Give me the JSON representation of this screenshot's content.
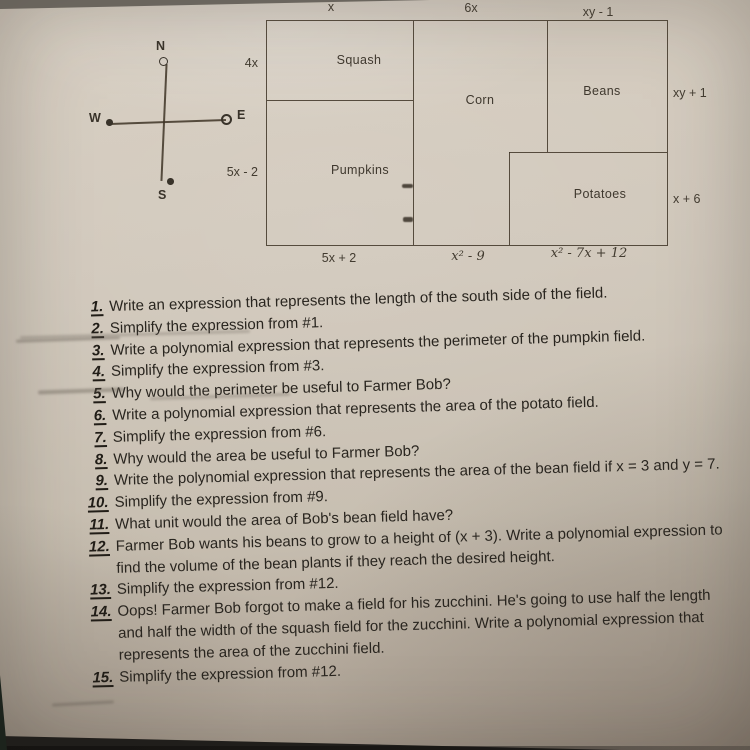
{
  "colors": {
    "paper": "#cfc6b9",
    "ink": "#3e3426",
    "surface": "#161412"
  },
  "diagram": {
    "compass": {
      "north": "N",
      "east": "E",
      "south": "S",
      "west": "W"
    },
    "field_regions": {
      "squash": "Squash",
      "corn": "Corn",
      "beans": "Beans",
      "pumpkins": "Pumpkins",
      "potatoes": "Potatoes"
    },
    "field_dimensions": {
      "top_squash": "x",
      "top_corn": "6x",
      "top_beans": "xy - 1",
      "left_squash": "4x",
      "left_pumpkins": "5x - 2",
      "right_beans": "xy + 1",
      "right_potatoes": "x + 6",
      "bottom_pumpkins": "5x + 2",
      "bottom_corn": "x² - 9",
      "bottom_potatoes": "x² - 7x + 12"
    }
  },
  "questions": [
    {
      "num": "1.",
      "text": "Write an expression that represents the length of the south side of the field."
    },
    {
      "num": "2.",
      "text": "Simplify the expression from #1."
    },
    {
      "num": "3.",
      "text": "Write a polynomial expression that represents the perimeter of the pumpkin field."
    },
    {
      "num": "4.",
      "text": "Simplify the expression from #3."
    },
    {
      "num": "5.",
      "text": "Why would the perimeter be useful to Farmer Bob?"
    },
    {
      "num": "6.",
      "text": "Write a polynomial expression that represents the area of the potato field."
    },
    {
      "num": "7.",
      "text": "Simplify the expression from #6."
    },
    {
      "num": "8.",
      "text": "Why would the area be useful to Farmer Bob?"
    },
    {
      "num": "9.",
      "text": "Write the polynomial expression that represents the area of the bean field if x = 3 and y = 7."
    },
    {
      "num": "10.",
      "text": "Simplify the expression from #9."
    },
    {
      "num": "11.",
      "text": "What unit would the area of Bob's bean field have?"
    },
    {
      "num": "12.",
      "text": "Farmer Bob wants his beans to grow to a height of (x + 3). Write a polynomial expression to find the volume of the bean plants if they reach the desired height."
    },
    {
      "num": "13.",
      "text": "Simplify the expression from #12."
    },
    {
      "num": "14.",
      "text": "Oops! Farmer Bob forgot to make a field for his zucchini. He's going to use half the length and half the width of the squash field for the zucchini. Write a polynomial expression that represents the area of the zucchini field."
    },
    {
      "num": "15.",
      "text": "Simplify the expression from #12."
    }
  ]
}
